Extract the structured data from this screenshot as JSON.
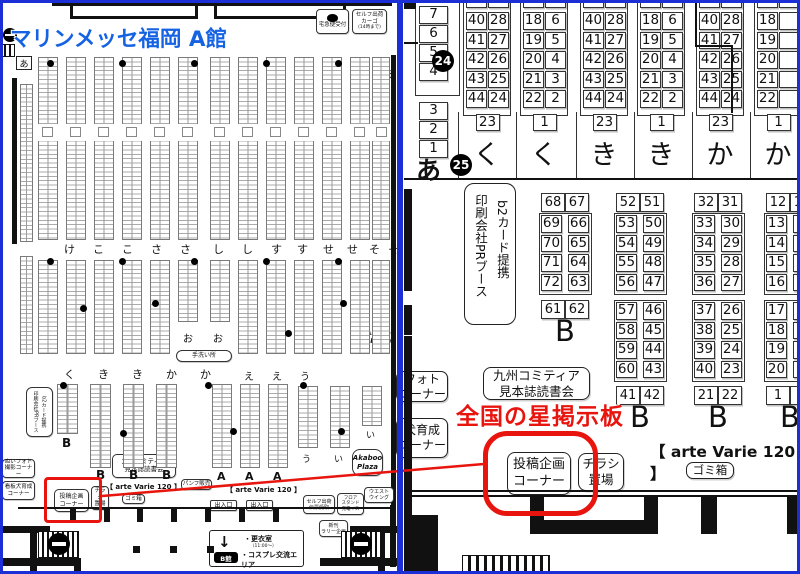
{
  "titles": {
    "left": "マリンメッセ福岡 A館",
    "right": "全国の星掲示板"
  },
  "colors": {
    "blue_border": "#1c2ed6",
    "title_blue": "#1563e2",
    "red": "#e8150f"
  },
  "left_map": {
    "a_left": "あ",
    "a_right": "あ",
    "takkyubin": "宅急便受付",
    "cargo": [
      "セルフ出荷",
      "カーゴ",
      "(14時まで)"
    ],
    "row1": [
      "け",
      "こ",
      "こ",
      "さ",
      "さ",
      "し",
      "し",
      "す",
      "す",
      "せ",
      "せ",
      "そ",
      "そ"
    ],
    "row2": [
      "く",
      "き",
      "き",
      "か",
      "か"
    ],
    "row3": [
      "え",
      "え",
      "う"
    ],
    "o_labels": [
      "お",
      "お"
    ],
    "low_labels": [
      "う",
      "い",
      "い"
    ],
    "tearai": "手洗い所",
    "b_labels": [
      "B",
      "B",
      "B",
      "B"
    ],
    "a_block_labels": [
      "A",
      "A",
      "A"
    ],
    "akaboo": [
      "Akaboo",
      "Plaza"
    ],
    "pr_booth": [
      "印刷会社PRブース",
      "b2カード提携"
    ],
    "kyushu": [
      "九州コミティア",
      "見本誌読書会"
    ],
    "nui_photo": [
      "ぬいフォト",
      "撮影コーナー"
    ],
    "dog": [
      "看板犬育成",
      "コーナー"
    ],
    "toukou": [
      "投稿企画",
      "コーナー"
    ],
    "chirashi": [
      "チラシ",
      "置場"
    ],
    "gomibako": "ゴミ箱",
    "arte_varie": "【 arte Varie 120 】",
    "pamph": "パンフ販売",
    "exit": "出入口",
    "self_denpyo": [
      "セルフ出荷",
      "伝票受取"
    ],
    "floor_stand": [
      "フロア",
      "スタンド",
      "充電イス"
    ],
    "west_wing": [
      "ウエスト",
      "ウイング"
    ],
    "shinkan": [
      "新刊",
      "ラリー企画"
    ],
    "b_kan": "B館",
    "changing": [
      "・更衣室",
      "（11:00～）",
      "・コスプレ交流エリア"
    ]
  },
  "right_map": {
    "side": {
      "top": [
        "7",
        "6",
        "5",
        "4"
      ],
      "bottom": [
        "3",
        "2",
        "1"
      ],
      "a": "あ",
      "badge_top": "24",
      "badge_bottom": "25"
    },
    "top_groups": [
      {
        "partial": [
          "39",
          "29"
        ],
        "col1": [
          "40",
          "41",
          "42",
          "43",
          "44"
        ],
        "col2": [
          "28",
          "27",
          "26",
          "25",
          "24"
        ],
        "footer": "23",
        "label": "く"
      },
      {
        "partial": [
          "17",
          "7"
        ],
        "col1": [
          "18",
          "19",
          "20",
          "21",
          "22"
        ],
        "col2": [
          "6",
          "5",
          "4",
          "3",
          "2"
        ],
        "footer": "1",
        "label": "く"
      },
      {
        "partial": [
          "39",
          "29"
        ],
        "col1": [
          "40",
          "41",
          "42",
          "43",
          "44"
        ],
        "col2": [
          "28",
          "27",
          "26",
          "25",
          "24"
        ],
        "footer": "23",
        "label": "き"
      },
      {
        "partial": [
          "17",
          "7"
        ],
        "col1": [
          "18",
          "19",
          "20",
          "21",
          "22"
        ],
        "col2": [
          "6",
          "5",
          "4",
          "3",
          "2"
        ],
        "footer": "1",
        "label": "き"
      },
      {
        "partial": [
          "39",
          "29"
        ],
        "col1": [
          "40",
          "41",
          "42",
          "43",
          "44"
        ],
        "col2": [
          "28",
          "27",
          "26",
          "25",
          "24"
        ],
        "footer": "23",
        "label": "か"
      },
      {
        "partial": [
          "17",
          ""
        ],
        "col1": [
          "18",
          "19",
          "20",
          "21",
          "22"
        ],
        "col2": [
          "",
          "",
          "",
          "",
          ""
        ],
        "footer": "1",
        "label": "か"
      }
    ],
    "pr_booth": [
      "印刷会社PRブース",
      "b2カード提携"
    ],
    "b_groups": [
      {
        "header": [
          "68",
          "67"
        ],
        "blocks": [
          {
            "c1": [
              "69",
              "70",
              "71",
              "72"
            ],
            "c2": [
              "66",
              "65",
              "64",
              "63"
            ]
          }
        ],
        "footer": [
          "61",
          "62"
        ],
        "label": "B"
      },
      {
        "header": [
          "52",
          "51"
        ],
        "blocks": [
          {
            "c1": [
              "53",
              "54",
              "55",
              "56"
            ],
            "c2": [
              "50",
              "49",
              "48",
              "47"
            ]
          },
          {
            "c1": [
              "57",
              "58",
              "59",
              "60"
            ],
            "c2": [
              "46",
              "45",
              "44",
              "43"
            ]
          }
        ],
        "footer": [
          "41",
          "42"
        ],
        "label": "B"
      },
      {
        "header": [
          "32",
          "31"
        ],
        "blocks": [
          {
            "c1": [
              "33",
              "34",
              "35",
              "36"
            ],
            "c2": [
              "30",
              "29",
              "28",
              "27"
            ]
          },
          {
            "c1": [
              "37",
              "38",
              "39",
              "40"
            ],
            "c2": [
              "26",
              "25",
              "24",
              "23"
            ]
          }
        ],
        "footer": [
          "21",
          "22"
        ],
        "label": "B"
      },
      {
        "header": [
          "12",
          "11"
        ],
        "blocks": [
          {
            "c1": [
              "13",
              "14",
              "15",
              "16"
            ],
            "c2": [
              "",
              "",
              "",
              ""
            ]
          },
          {
            "c1": [
              "17",
              "18",
              "19",
              "20"
            ],
            "c2": [
              "",
              "",
              "",
              ""
            ]
          }
        ],
        "footer": [
          "1",
          ""
        ],
        "label": "B"
      }
    ],
    "arte_varie": "【 arte Varie 120 】",
    "gomibako": "ゴミ箱",
    "kyushu": [
      "九州コミティア",
      "見本誌読書会"
    ],
    "toukou": [
      "投稿企画",
      "コーナー"
    ],
    "chirashi": [
      "チラシ",
      "置場"
    ],
    "photo_corner": [
      "フォト",
      "コーナー"
    ],
    "dog_corner": [
      "犬育成",
      "コーナー"
    ]
  }
}
